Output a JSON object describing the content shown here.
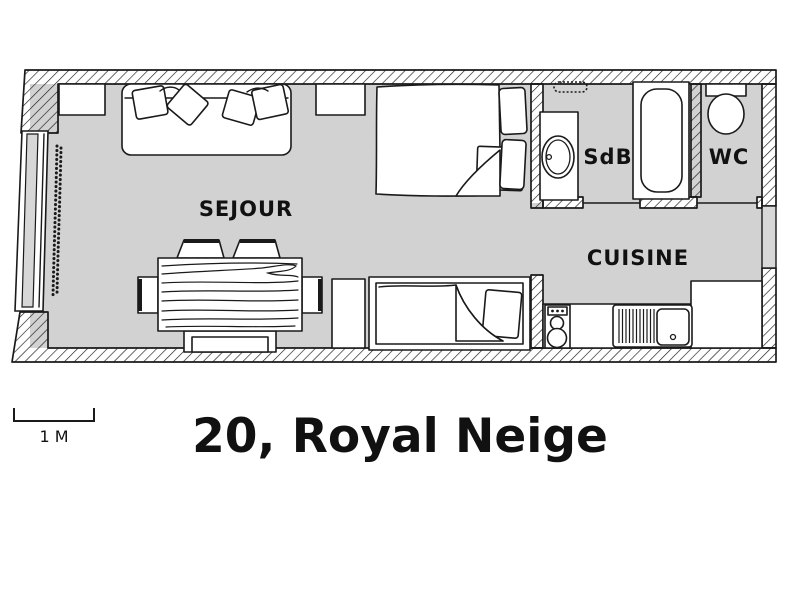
{
  "title": "20, Royal Neige",
  "scale_bar": {
    "label": "1 M"
  },
  "rooms": {
    "sejour": "SEJOUR",
    "sdb": "SdB",
    "wc": "WC",
    "cuisine": "CUISINE"
  },
  "colors": {
    "floor": "#d2d2d2",
    "line": "#1a1a1a",
    "background": "#ffffff"
  },
  "furniture": [
    "sofa",
    "sofa-cushions",
    "dining-table",
    "dining-chairs",
    "double-bed",
    "single-bed",
    "bedside-table",
    "wall-shelf",
    "window",
    "bead-curtain",
    "washbasin",
    "towel-rail",
    "bathtub",
    "toilet",
    "stove",
    "kitchen-sink",
    "drainboard",
    "kitchen-counter"
  ]
}
